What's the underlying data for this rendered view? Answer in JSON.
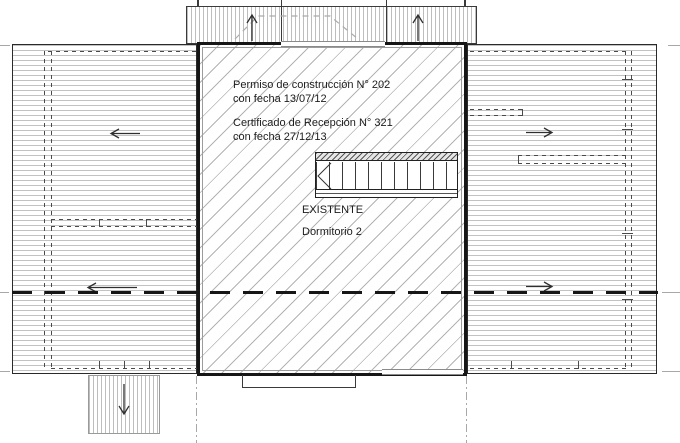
{
  "plan": {
    "notes": [
      {
        "line1": "Permiso de construcción N° 202",
        "line2": "con fecha 13/07/12"
      },
      {
        "line1": "Certificado de Recepción N° 321",
        "line2": "con fecha 27/12/13"
      }
    ],
    "room": {
      "status": "EXISTENTE",
      "name": "Dormitorio 2"
    }
  },
  "icons": {
    "slope_arrow_left": "←",
    "slope_arrow_right": "→",
    "slope_arrow_up": "↑",
    "slope_arrow_down": "↓"
  },
  "colors": {
    "ink": "#1c1c1c",
    "wall": "#161616",
    "hatch": "#b8b8b8",
    "hidden_line": "#4a4a4a",
    "axis_gray": "#a8a8a8",
    "background": "#ffffff"
  }
}
